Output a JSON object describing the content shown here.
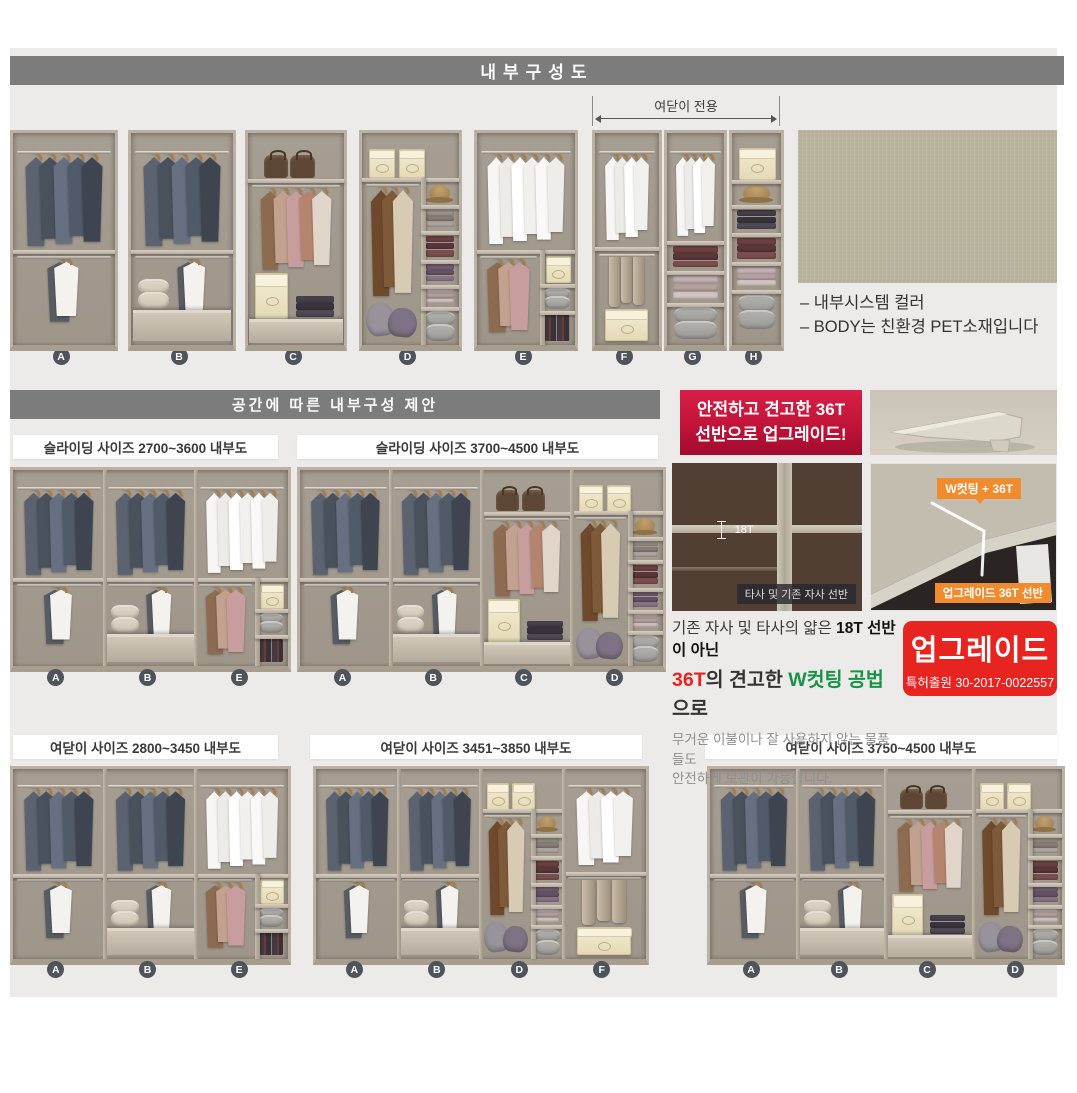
{
  "page": {
    "title_bar": "내부구성도",
    "proposal_bar": "공간에 따른 내부구성 제안"
  },
  "top_section": {
    "hinged_only_label": "여닫이 전용",
    "unit_letters": [
      "A",
      "B",
      "C",
      "D",
      "E",
      "F",
      "G",
      "H"
    ],
    "swatch_captions": [
      "– 내부시스템 컬러",
      "– BODY는 친환경 PET소재입니다"
    ]
  },
  "panels": [
    {
      "title": "슬라이딩 사이즈 2700~3600 내부도",
      "modules": [
        "A",
        "B",
        "E"
      ]
    },
    {
      "title": "슬라이딩 사이즈 3700~4500 내부도",
      "modules": [
        "A",
        "B",
        "C",
        "D"
      ]
    },
    {
      "title": "여닫이 사이즈 2800~3450 내부도",
      "modules": [
        "A",
        "B",
        "E"
      ]
    },
    {
      "title": "여닫이 사이즈 3451~3850 내부도",
      "modules": [
        "A",
        "B",
        "D",
        "F"
      ]
    },
    {
      "title": "여닫이 사이즈 3750~4500 내부도",
      "modules": [
        "A",
        "B",
        "C",
        "D"
      ]
    }
  ],
  "upgrade": {
    "banner_line1": "안전하고 견고한 36T",
    "banner_line2": "선반으로 업그레이드!",
    "old_thickness_label": "18T",
    "old_caption": "타사 및 기존 자사 선반",
    "new_badge": "W컷팅 + 36T",
    "new_caption": "업그레이드 36T 선반",
    "desc_line1_normal": "기존 자사 및 타사의 얇은 ",
    "desc_line1_bold": "18T 선반이 아닌",
    "desc_line2_red": "36T",
    "desc_line2_mid": "의 견고한 ",
    "desc_line2_green": "W컷팅 공법",
    "desc_line2_tail": "으로",
    "desc_body1": "무거운 이불이나 잘 사용하지 않는 물품들도",
    "desc_body2": "안전하게 보관이 가능합니다.",
    "stamp_title": "업그레이드",
    "stamp_sub": "특허출원 30-2017-0022557"
  },
  "colors": {
    "bar_gray": "#7c7c7c",
    "content_bg": "#ecebe9",
    "accent_red": "#e72420",
    "banner_red_top": "#d81f47",
    "banner_red_bottom": "#a20b2e",
    "orange": "#f08c2e",
    "green_text": "#169347",
    "label_circle": "#4d545b",
    "swatch_green": "#b5b19b"
  },
  "wardrobe_units": {
    "A": [
      {
        "t": "rod",
        "x": 4,
        "y": 8.5,
        "w": 92
      },
      {
        "t": "hang",
        "x": 9,
        "y": 8.5,
        "w": 82,
        "h": 45,
        "v": "suit",
        "n": 5
      },
      {
        "t": "shelf",
        "x": 0,
        "y": 55,
        "w": 100
      },
      {
        "t": "rod",
        "x": 4,
        "y": 58,
        "w": 92
      },
      {
        "t": "hang",
        "x": 30,
        "y": 58,
        "w": 38,
        "h": 31,
        "v": "mix2",
        "n": 2
      }
    ],
    "B": [
      {
        "t": "rod",
        "x": 4,
        "y": 8.5,
        "w": 92
      },
      {
        "t": "hang",
        "x": 9,
        "y": 8.5,
        "w": 82,
        "h": 45,
        "v": "suit",
        "n": 5
      },
      {
        "t": "shelf",
        "x": 0,
        "y": 55,
        "w": 100
      },
      {
        "t": "rod",
        "x": 4,
        "y": 58,
        "w": 92
      },
      {
        "t": "hang",
        "x": 42,
        "y": 58,
        "w": 34,
        "h": 29,
        "v": "mix2",
        "n": 2
      },
      {
        "t": "baskets",
        "x": 7,
        "y": 69,
        "w": 30,
        "h": 14,
        "v": "cream"
      },
      {
        "t": "drawer",
        "x": 1.5,
        "y": 83.5,
        "w": 97,
        "h": 13
      }
    ],
    "C": [
      {
        "t": "bags",
        "x": 14,
        "y": 8,
        "w": 58,
        "h": 13
      },
      {
        "t": "shelf",
        "x": 0,
        "y": 21.5,
        "w": 100
      },
      {
        "t": "rod",
        "x": 4,
        "y": 24.5,
        "w": 92
      },
      {
        "t": "hang",
        "x": 10,
        "y": 24.5,
        "w": 80,
        "h": 40,
        "v": "casual",
        "n": 5
      },
      {
        "t": "boxp",
        "x": 7,
        "y": 66,
        "w": 33,
        "h": 21
      },
      {
        "t": "folded",
        "x": 50,
        "y": 77,
        "w": 40,
        "h": 10,
        "v": "dark"
      },
      {
        "t": "drawer",
        "x": 1.5,
        "y": 87.5,
        "w": 97,
        "h": 10
      }
    ],
    "D": [
      {
        "t": "boxp",
        "x": 7,
        "y": 7.5,
        "w": 25,
        "h": 13
      },
      {
        "t": "boxp",
        "x": 38,
        "y": 7.5,
        "w": 25,
        "h": 13
      },
      {
        "t": "shelf",
        "x": 0,
        "y": 21,
        "w": 100
      },
      {
        "t": "vdiv",
        "x": 61,
        "y": 21,
        "h": 79
      },
      {
        "t": "rod",
        "x": 4,
        "y": 24,
        "w": 55
      },
      {
        "t": "hang",
        "x": 6,
        "y": 24,
        "w": 50,
        "h": 53,
        "v": "coat",
        "n": 3
      },
      {
        "t": "pillows",
        "x": 4,
        "y": 79,
        "w": 54,
        "h": 17
      },
      {
        "t": "hat",
        "x": 69,
        "y": 24.5,
        "w": 22,
        "h": 8
      },
      {
        "t": "shelf",
        "x": 61,
        "y": 34,
        "w": 39
      },
      {
        "t": "folded",
        "x": 66,
        "y": 36.5,
        "w": 29,
        "h": 8,
        "v": "gray"
      },
      {
        "t": "shelf",
        "x": 61,
        "y": 46,
        "w": 39
      },
      {
        "t": "folded",
        "x": 66,
        "y": 48.5,
        "w": 29,
        "h": 10,
        "v": "maroon"
      },
      {
        "t": "shelf",
        "x": 61,
        "y": 60,
        "w": 39
      },
      {
        "t": "folded",
        "x": 66,
        "y": 62,
        "w": 29,
        "h": 8,
        "v": "plum"
      },
      {
        "t": "shelf",
        "x": 61,
        "y": 71.5,
        "w": 39
      },
      {
        "t": "folded",
        "x": 66,
        "y": 73.5,
        "w": 29,
        "h": 7,
        "v": "pink"
      },
      {
        "t": "shelf",
        "x": 61,
        "y": 82,
        "w": 39
      },
      {
        "t": "baskets",
        "x": 65,
        "y": 84,
        "w": 31,
        "h": 14,
        "v": "gray"
      }
    ],
    "E": [
      {
        "t": "rod",
        "x": 4,
        "y": 8.5,
        "w": 92
      },
      {
        "t": "hang",
        "x": 8,
        "y": 8.5,
        "w": 84,
        "h": 44,
        "v": "shirt",
        "n": 6
      },
      {
        "t": "shelf",
        "x": 0,
        "y": 55,
        "w": 100
      },
      {
        "t": "vdiv",
        "x": 64,
        "y": 55,
        "h": 45
      },
      {
        "t": "rod",
        "x": 3,
        "y": 58,
        "w": 58
      },
      {
        "t": "hang",
        "x": 7,
        "y": 58,
        "w": 50,
        "h": 36,
        "v": "casual",
        "n": 3
      },
      {
        "t": "boxp",
        "x": 70,
        "y": 58,
        "w": 24,
        "h": 12
      },
      {
        "t": "shelf",
        "x": 64,
        "y": 71,
        "w": 36
      },
      {
        "t": "baskets",
        "x": 68,
        "y": 73,
        "w": 27,
        "h": 10,
        "v": "gray"
      },
      {
        "t": "shelf",
        "x": 64,
        "y": 84,
        "w": 36
      },
      {
        "t": "books",
        "x": 68,
        "y": 86,
        "w": 27,
        "h": 12
      }
    ],
    "F": [
      {
        "t": "rod",
        "x": 6,
        "y": 8.5,
        "w": 88
      },
      {
        "t": "hang",
        "x": 12,
        "y": 8.5,
        "w": 76,
        "h": 42,
        "v": "shirt",
        "n": 4
      },
      {
        "t": "shelf",
        "x": 0,
        "y": 54,
        "w": 100
      },
      {
        "t": "rod",
        "x": 6,
        "y": 57,
        "w": 88
      },
      {
        "t": "trousers",
        "x": 17,
        "y": 57,
        "w": 64,
        "h": 25
      },
      {
        "t": "boxp",
        "x": 16,
        "y": 83,
        "w": 64,
        "h": 14
      }
    ],
    "G": [
      {
        "t": "rod",
        "x": 6,
        "y": 8.5,
        "w": 88
      },
      {
        "t": "hang",
        "x": 12,
        "y": 8.5,
        "w": 76,
        "h": 40,
        "v": "shirt",
        "n": 4
      },
      {
        "t": "shelf",
        "x": 0,
        "y": 51,
        "w": 100
      },
      {
        "t": "folded",
        "x": 10,
        "y": 53.5,
        "w": 80,
        "h": 10,
        "v": "maroon"
      },
      {
        "t": "shelf",
        "x": 0,
        "y": 65,
        "w": 100
      },
      {
        "t": "folded",
        "x": 10,
        "y": 67.5,
        "w": 80,
        "h": 11,
        "v": "pink"
      },
      {
        "t": "shelf",
        "x": 0,
        "y": 80,
        "w": 100
      },
      {
        "t": "baskets",
        "x": 12,
        "y": 82,
        "w": 76,
        "h": 15,
        "v": "gray"
      }
    ],
    "H": [
      {
        "t": "boxp",
        "x": 14,
        "y": 7,
        "w": 72,
        "h": 14
      },
      {
        "t": "shelf",
        "x": 0,
        "y": 22,
        "w": 100
      },
      {
        "t": "hat",
        "x": 22,
        "y": 24.5,
        "w": 56,
        "h": 8
      },
      {
        "t": "shelf",
        "x": 0,
        "y": 34,
        "w": 100
      },
      {
        "t": "folded",
        "x": 11,
        "y": 36.5,
        "w": 78,
        "h": 9,
        "v": "dark"
      },
      {
        "t": "shelf",
        "x": 0,
        "y": 47,
        "w": 100
      },
      {
        "t": "folded",
        "x": 11,
        "y": 49.5,
        "w": 78,
        "h": 10,
        "v": "maroon"
      },
      {
        "t": "shelf",
        "x": 0,
        "y": 61,
        "w": 100
      },
      {
        "t": "folded",
        "x": 11,
        "y": 63.5,
        "w": 78,
        "h": 9,
        "v": "pink"
      },
      {
        "t": "shelf",
        "x": 0,
        "y": 74,
        "w": 100
      },
      {
        "t": "baskets",
        "x": 13,
        "y": 76.5,
        "w": 74,
        "h": 16,
        "v": "gray"
      }
    ]
  }
}
